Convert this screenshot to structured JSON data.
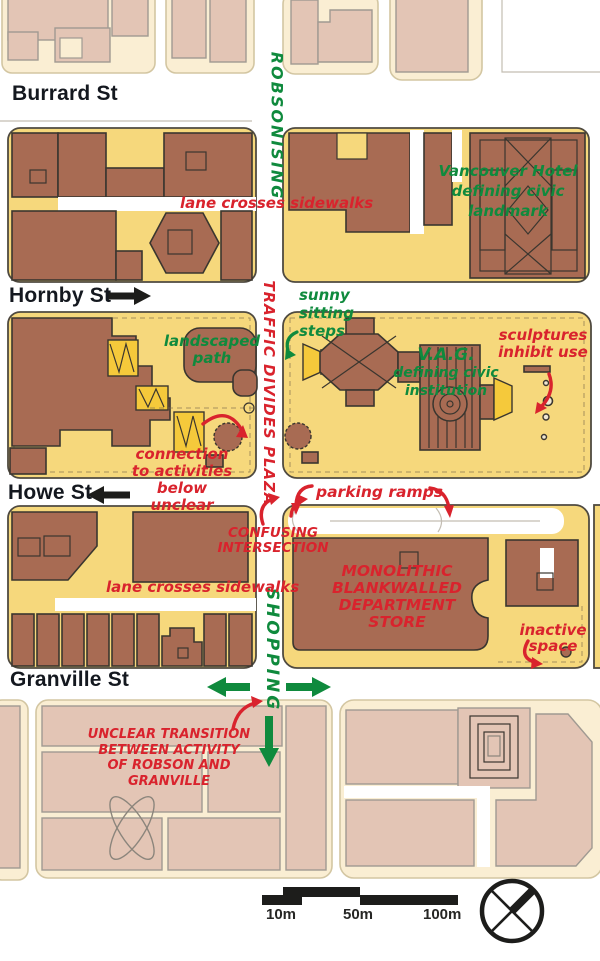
{
  "colors": {
    "red": "#d9232d",
    "green": "#0f8a3d",
    "brown": "#a86b53",
    "yellow": "#f6d87c",
    "accent_yellow": "#f5c93b",
    "pink": "#e3c5b5",
    "cream": "#faeed3",
    "ink": "#3a362f",
    "street_text": "#14181f"
  },
  "streets": {
    "burrard": "Burrard St",
    "hornby": "Hornby St",
    "howe": "Howe St",
    "granville": "Granville St"
  },
  "corridor": {
    "robsonising": "ROBSONISING",
    "traffic_divides_plaza": "TRAFFIC DIVIDES PLAZA",
    "shopping": "SHOPPING"
  },
  "annotations": {
    "lane_crosses_1": "lane crosses sidewalks",
    "lane_crosses_2": "lane crosses sidewalks",
    "hotel_l1": "Vancouver Hotel",
    "hotel_l2": "defining civic",
    "hotel_l3": "landmark",
    "sunny_l1": "sunny",
    "sunny_l2": "sitting",
    "sunny_l3": "steps",
    "landscaped_l1": "landscaped",
    "landscaped_l2": "path",
    "vag_l1": "V.A.G.",
    "vag_l2": "defining civic",
    "vag_l3": "institution",
    "sculptures_l1": "sculptures",
    "sculptures_l2": "inhibit use",
    "connection_l1": "connection",
    "connection_l2": "to activities",
    "connection_l3": "below unclear",
    "parking": "parking ramps",
    "confusing_l1": "CONFUSING",
    "confusing_l2": "INTERSECTION",
    "monolithic_l1": "MONOLITHIC",
    "monolithic_l2": "BLANKWALLED",
    "monolithic_l3": "DEPARTMENT",
    "monolithic_l4": "STORE",
    "inactive_l1": "inactive",
    "inactive_l2": "space",
    "unclear_l1": "UNCLEAR TRANSITION",
    "unclear_l2": "BETWEEN ACTIVITY",
    "unclear_l3": "OF ROBSON AND",
    "unclear_l4": "GRANVILLE"
  },
  "scale_bar": {
    "t10": "10m",
    "t50": "50m",
    "t100": "100m"
  }
}
